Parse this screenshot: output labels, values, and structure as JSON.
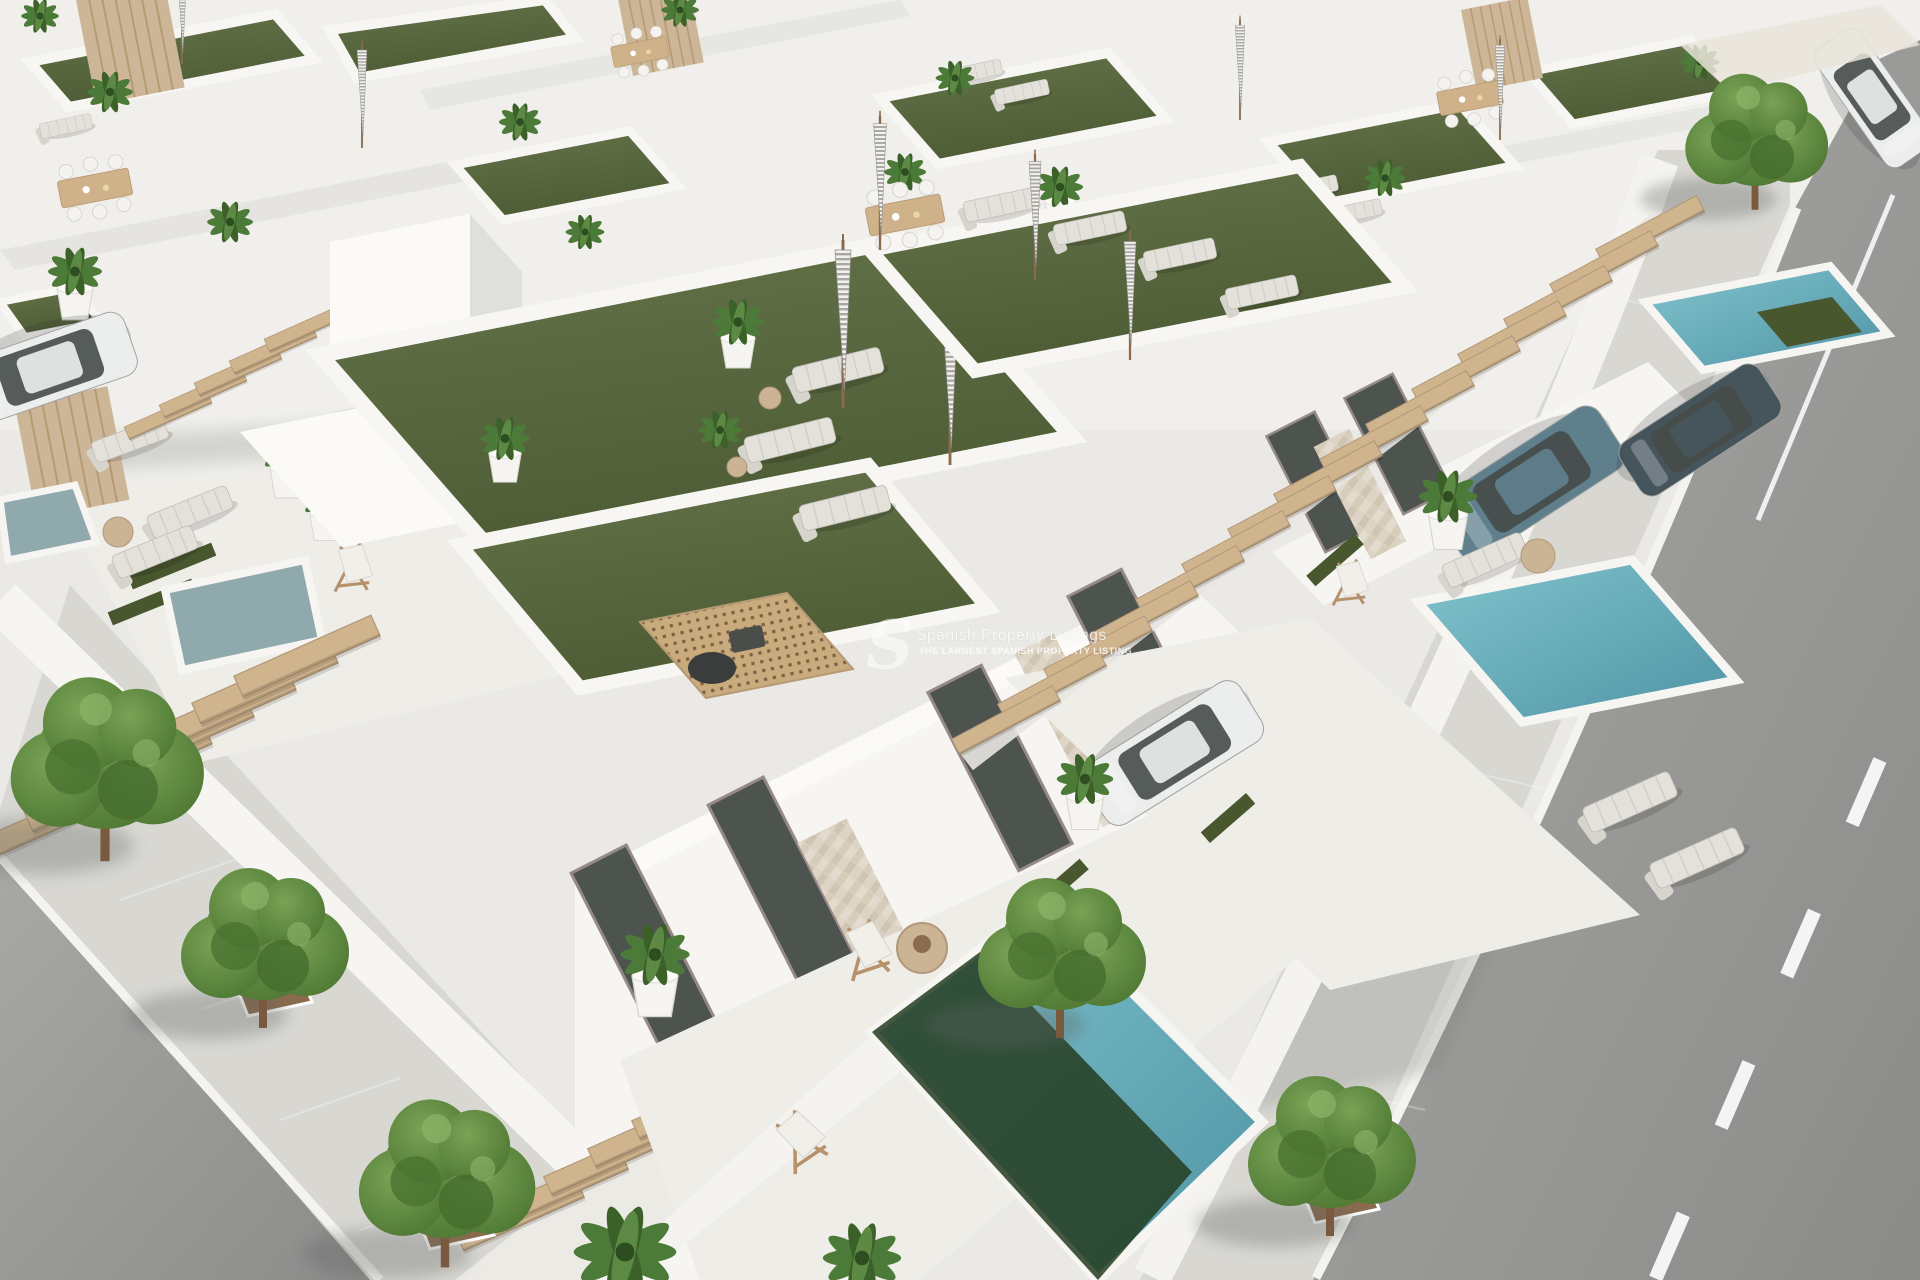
{
  "meta": {
    "kind": "3D architectural aerial render",
    "width": 1920,
    "height": 1280
  },
  "watermark": {
    "logo_letter": "S",
    "title": "Spanish Property Listings",
    "tagline": "THE LARGEST SPANISH PROPERTY LISTING"
  },
  "palette": {
    "bg": "#e7e6e2",
    "bgUpper": "#f0efeb",
    "wall": "#f6f5f2",
    "wallBright": "#fbfaf7",
    "wallShade": "#dfe0dc",
    "wallDark": "#c9cbc7",
    "floor": "#eeede8",
    "sidewalk": "#d8d7d2",
    "coping": "#f6f5f2",
    "grass1": "#64734a",
    "grass2": "#4d5c34",
    "grassDark": "#49572f",
    "pool1": "#82c4cd",
    "pool2": "#4f94a6",
    "poolGray": "#8fa9ad",
    "poolShadow": "#243c20",
    "road1": "#a7a7a5",
    "road2": "#8b8c8a",
    "wood": "#cdb48e",
    "woodDark": "#b3977a",
    "stone1": "#ddd4c6",
    "stone2": "#cfc5b2",
    "glass": "#4d534f",
    "frame": "#968a88",
    "carWhite": "#eceded",
    "carBlue": "#5f7f8d",
    "carDark": "#46555c",
    "tree1": "#79a355",
    "tree2": "#4a7330",
    "palm": "#4c7a38",
    "pit": "#8a6b4e"
  },
  "scene": {
    "description": "Aerial 3D render of a development of modern white villas with rooftop artificial-grass terraces, sun loungers, closed parasols, potted palms, outdoor dining sets, barbecue decks, timber staircases and pergolas, private plunge pools, driveways with parked cars, and tree-lined asphalt streets with paved sidewalks.",
    "rooftop_items": [
      "artificial grass lawn",
      "sun loungers",
      "closed striped parasols",
      "potted palms in white planters",
      "outdoor dining table with chairs",
      "perforated timber barbecue deck",
      "outdoor shower"
    ],
    "ground_items": [
      "private plunge pools",
      "timber open-tread staircases",
      "pergola beams",
      "full-height glass doors",
      "stone-clad facade panels",
      "timber deck chairs",
      "round rattan side tables",
      "driveways with grass strips"
    ],
    "cars": [
      {
        "color": "white",
        "location": "left driveway"
      },
      {
        "color": "white",
        "location": "central driveway"
      },
      {
        "color": "blue-gray SUV",
        "location": "right driveway"
      },
      {
        "color": "dark gray",
        "location": "top-right courtyard"
      },
      {
        "color": "white",
        "location": "top-right road"
      }
    ],
    "pools": [
      {
        "location": "left patio",
        "color": "gray-teal"
      },
      {
        "location": "center foreground",
        "color": "turquoise with dark green shaded end"
      },
      {
        "location": "right courtyard",
        "color": "turquoise"
      },
      {
        "location": "top-right courtyard",
        "color": "turquoise with green ledge"
      }
    ],
    "streets": {
      "left": "asphalt road with white curb line and paved sidewalk",
      "right": "asphalt road with white dashed lane markings and paved sidewalk",
      "trees": "green street trees in brown square planting pits"
    }
  }
}
